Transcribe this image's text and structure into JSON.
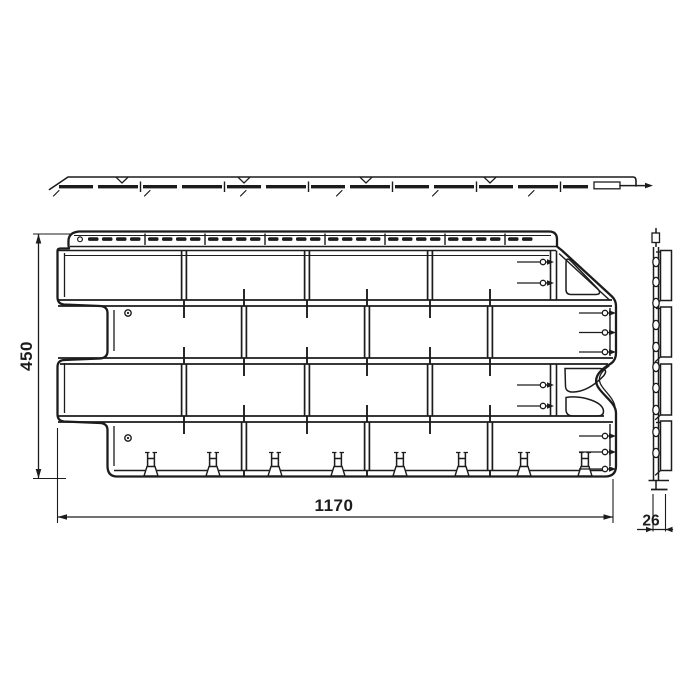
{
  "title": "Facade panel technical drawing",
  "colors": {
    "background": "#ffffff",
    "line": "#1c1c1c"
  },
  "views": {
    "top": {
      "name": "top-view"
    },
    "front": {
      "name": "front-view"
    },
    "side": {
      "name": "side-view"
    }
  },
  "dimensions": {
    "width_mm": "1170",
    "height_mm": "450",
    "depth_mm": "26"
  }
}
